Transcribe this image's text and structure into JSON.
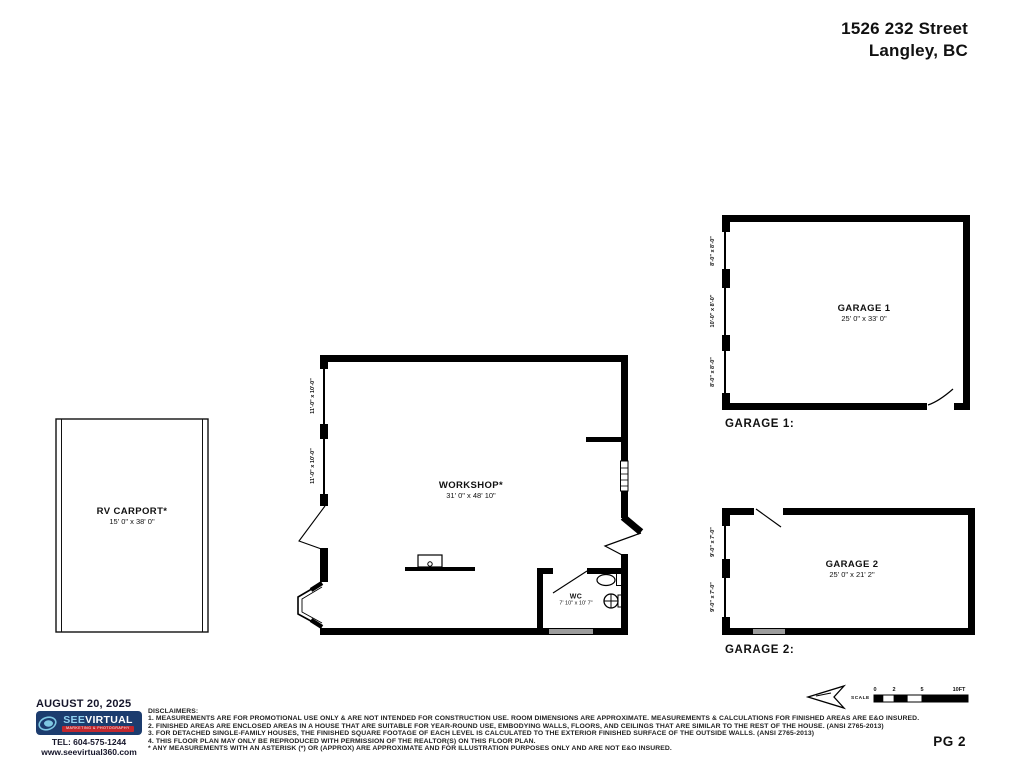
{
  "header": {
    "address_line1": "1526 232 Street",
    "address_line2": "Langley, BC"
  },
  "plan": {
    "rv_carport": {
      "name": "RV CARPORT*",
      "dims": "15' 0\" x 38' 0\""
    },
    "workshop": {
      "name": "WORKSHOP*",
      "dims": "31' 0\" x 48' 10\"",
      "openings": [
        "11'-0\" x 10'-0\"",
        "11'-0\" x 10'-0\""
      ]
    },
    "wc": {
      "name": "WC",
      "dims": "7' 10\" x 10' 7\""
    },
    "garage1": {
      "name": "GARAGE 1",
      "dims": "25' 0\" x 33' 0\"",
      "caption": "GARAGE 1:",
      "openings": [
        "8'-0\" x 8'-0\"",
        "10'-0\" x 8'-0\"",
        "8'-0\" x 8'-0\""
      ]
    },
    "garage2": {
      "name": "GARAGE 2",
      "dims": "25' 0\" x 21' 2\"",
      "caption": "GARAGE 2:",
      "openings": [
        "9'-0\" x 7'-0\"",
        "9'-0\" x 7'-0\""
      ]
    }
  },
  "footer": {
    "date": "AUGUST 20, 2025",
    "logo": {
      "see": "SEE",
      "virtual": "VIRTUAL",
      "tagline": "MARKETING & PHOTOGRAPHY"
    },
    "tel": "TEL: 604-575-1244",
    "website": "www.seevirtual360.com",
    "page": "PG 2"
  },
  "disclaimers": {
    "title": "DISCLAIMERS:",
    "lines": [
      "1. MEASUREMENTS ARE FOR PROMOTIONAL USE ONLY & ARE NOT INTENDED FOR CONSTRUCTION USE. ROOM DIMENSIONS ARE APPROXIMATE. MEASUREMENTS & CALCULATIONS FOR FINISHED AREAS ARE E&O INSURED.",
      "2. FINISHED AREAS ARE ENCLOSED AREAS IN A HOUSE THAT ARE SUITABLE FOR YEAR-ROUND USE, EMBODYING WALLS, FLOORS, AND CEILINGS THAT ARE SIMILAR TO THE REST OF THE HOUSE. (ANSI Z765-2013)",
      "3. FOR DETACHED SINGLE-FAMILY HOUSES, THE FINISHED SQUARE FOOTAGE OF EACH LEVEL IS CALCULATED TO THE EXTERIOR FINISHED SURFACE OF THE OUTSIDE WALLS. (ANSI Z765-2013)",
      "4. THIS FLOOR PLAN MAY ONLY BE REPRODUCED WITH PERMISSION OF THE REALTOR(S) ON THIS FLOOR PLAN.",
      "* ANY MEASUREMENTS WITH AN ASTERISK (*) OR (APPROX) ARE APPROXIMATE AND FOR ILLUSTRATION PURPOSES ONLY AND ARE NOT E&O INSURED."
    ]
  },
  "scale": {
    "label": "SCALE",
    "ticks": [
      "0",
      "2",
      "5",
      "10FT"
    ]
  },
  "colors": {
    "logo_navy": "#1c3c6e",
    "logo_light_blue": "#5aa7d8",
    "logo_red": "#c1272d",
    "wall": "#000000",
    "window_gray": "#9c9c9c"
  }
}
